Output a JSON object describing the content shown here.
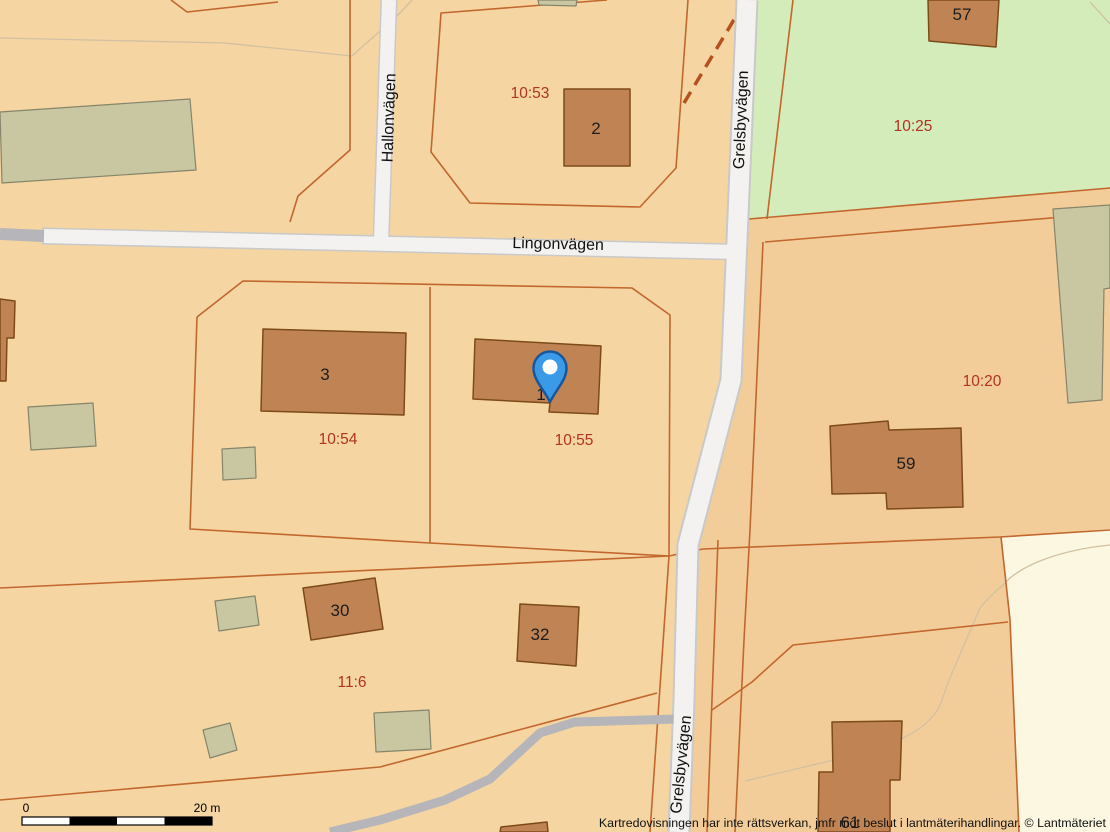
{
  "streets": {
    "hallonvagen": "Hallonvägen",
    "lingonvagen": "Lingonvägen",
    "grelsbyvagen": "Grelsbyvägen"
  },
  "parcels": {
    "p10_53": "10:53",
    "p10_25": "10:25",
    "p10_54": "10:54",
    "p10_55": "10:55",
    "p10_20": "10:20",
    "p11_6": "11:6"
  },
  "buildings": {
    "b1": "1",
    "b2": "2",
    "b3": "3",
    "b30": "30",
    "b32": "32",
    "b57": "57",
    "b59": "59",
    "b61": "61"
  },
  "scale_bar": {
    "zero_label": "0",
    "max_label": "20 m"
  },
  "attribution": "Kartredovisningen har inte rättsverkan, jmfr mot beslut i lantmäterihandlingar. © Lantmäteriet",
  "colors": {
    "background": "#f5d5a2",
    "parcel_east": "#f3cd99",
    "green_area": "#d4ecba",
    "cream_area": "#fcf7e0",
    "building_fill": "#c08454",
    "building_stroke": "#7d4a1a",
    "shed_fill": "#c9c6a2",
    "shed_stroke": "#85856a",
    "road_casing": "#c9c9c9",
    "road_fill": "#f3f2f0",
    "path_gray": "#b5b5ba",
    "boundary_line": "#c2672e",
    "dashed_line": "#b5511f",
    "contour_line": "#d2c0a2",
    "parcel_label": "#b03324",
    "pin_blue": "#3a9ae8",
    "pin_stroke": "#19579b"
  }
}
